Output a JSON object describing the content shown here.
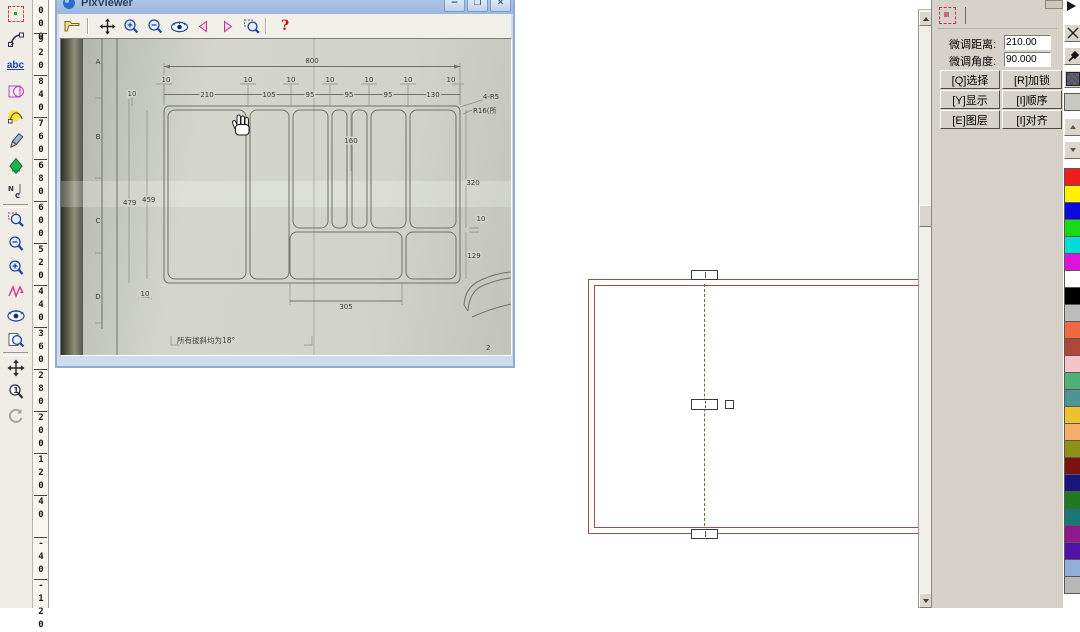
{
  "top_toolbar": {
    "preset_buttons": [
      "160",
      "2240",
      "2320",
      "2400",
      "2400",
      "2500",
      "2640",
      "2720",
      "2800",
      "2800mm"
    ]
  },
  "left_toolbar": {
    "icons": [
      "select-tool",
      "node-edit-tool",
      "text-tool",
      "shape-tool",
      "curve-tool",
      "pencil-tool",
      "engrave-3d-tool",
      "nc-path-tool",
      "zoom-region-tool",
      "zoom-out-tool",
      "zoom-in-tool",
      "redraw-tool",
      "preview-eye-tool",
      "zoom-page-tool",
      "pan-tool",
      "zoom-actual-tool",
      "refresh-tool"
    ],
    "text_tool_label": "abc"
  },
  "ruler": {
    "labels": [
      "1000",
      "920",
      "840",
      "760",
      "680",
      "600",
      "520",
      "440",
      "360",
      "280",
      "200",
      "120",
      "40",
      "-40",
      "-120"
    ]
  },
  "pixviewer": {
    "title": "PixViewer",
    "window_buttons": {
      "minimize": "−",
      "maximize": "❐",
      "close": "✕"
    },
    "toolbar_icons": [
      "open-file",
      "pan",
      "zoom-in",
      "zoom-out",
      "preview-eye",
      "prev-image",
      "next-image",
      "zoom-select",
      "help"
    ],
    "help_label": "?",
    "drawing": {
      "overall_width": "800",
      "gap": "10",
      "col_widths": [
        "210",
        "105",
        "95",
        "95",
        "95",
        "130"
      ],
      "height_outer": "479",
      "height_inner": "459",
      "left_gap_top": "10",
      "left_gap_bottom": "10",
      "mid_height": "160",
      "right_top": "320",
      "right_gap": "10",
      "right_bottom": "129",
      "bottom_width": "305",
      "note_radius1": "4-R5",
      "note_radius2": "R16(所",
      "note_draft": "所有拔斜均为18°",
      "zones": [
        "A",
        "B",
        "C",
        "D"
      ],
      "page": "2"
    }
  },
  "canvas": {
    "rect_color": "#A14B4B",
    "centerline_color": "#4F7A28"
  },
  "panel": {
    "fields": [
      {
        "label": "微调距离:",
        "value": "210.00"
      },
      {
        "label": "微调角度:",
        "value": "90.000"
      }
    ],
    "buttons": [
      "[Q]选择",
      "[R]加锁",
      "[Y]显示",
      "[I]顺序",
      "[E]图层",
      "[I]对齐"
    ]
  },
  "palette": {
    "colors": [
      "#ee1c1c",
      "#fff200",
      "#0a0ae0",
      "#18d818",
      "#00dcdc",
      "#dc14dc",
      "#ffffff",
      "#000000",
      "#bcbcbc",
      "#ef6a42",
      "#b0453a",
      "#f6c3cb",
      "#4fb07a",
      "#4e9494",
      "#eec22e",
      "#f5ad69",
      "#8f9018",
      "#7c1212",
      "#16167c",
      "#1f7a1f",
      "#187878",
      "#8c1a8c",
      "#5012a8",
      "#90aed6",
      "#b8b8b8"
    ]
  }
}
